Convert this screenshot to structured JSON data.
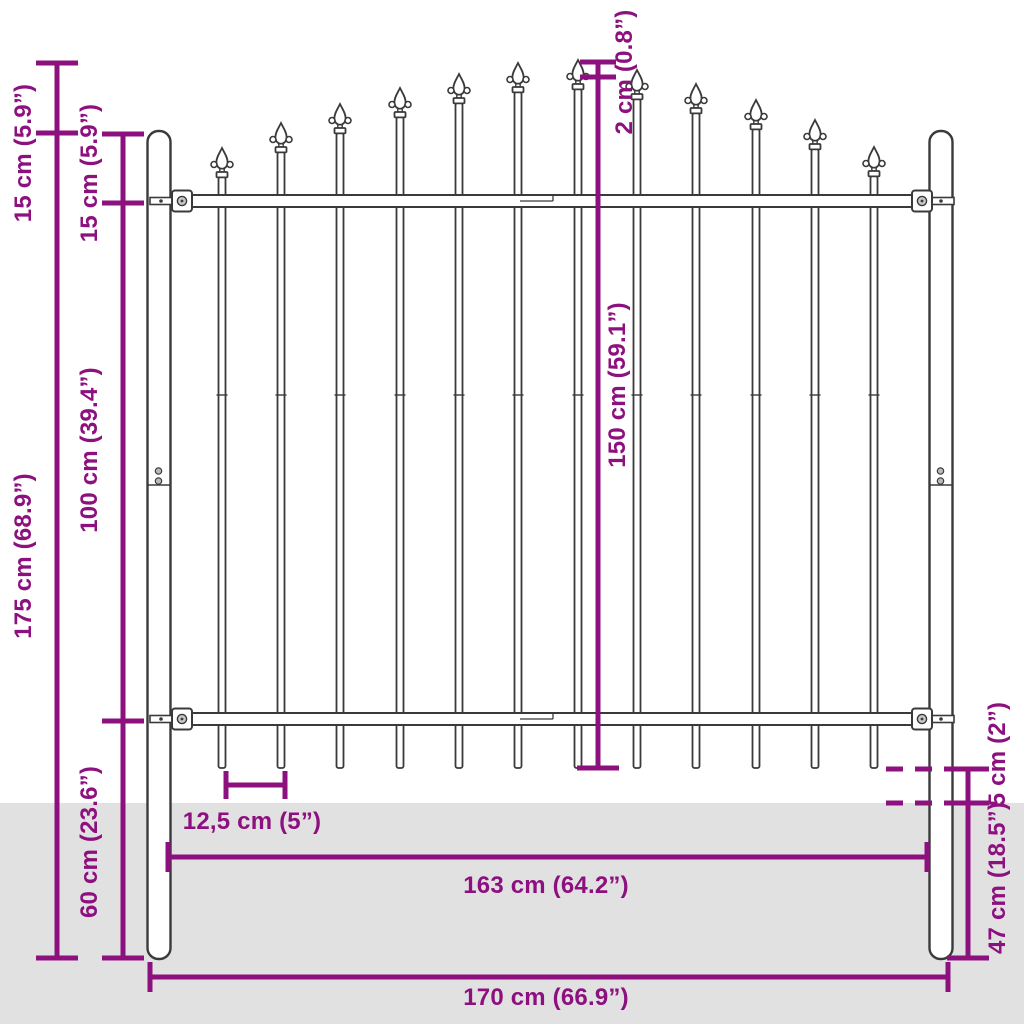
{
  "title": "Fence panel dimension diagram",
  "colors": {
    "dimension_accent": "#8D107F",
    "ground": "#E2E1E2",
    "fence_outline": "#3A3A3A",
    "background": "#FFFFFF"
  },
  "fence": {
    "type": "steel fence panel with spear-top pickets and round posts",
    "picket_count": 12,
    "post_count": 2,
    "rail_count": 2
  },
  "dimensions": {
    "post_above_spears": {
      "label": "15 cm (5.9”)",
      "orientation": "vertical"
    },
    "post_top_to_top_rail": {
      "label": "15 cm (5.9”)",
      "orientation": "vertical"
    },
    "between_rails": {
      "label": "100 cm (39.4”)",
      "orientation": "vertical"
    },
    "post_length": {
      "label": "175 cm (68.9”)",
      "orientation": "vertical"
    },
    "bottom_rail_to_post_end": {
      "label": "60 cm (23.6”)",
      "orientation": "vertical"
    },
    "spear_tip_offset": {
      "label": "2 cm (0.8”)",
      "orientation": "vertical"
    },
    "picket_height": {
      "label": "150 cm (59.1”)",
      "orientation": "vertical"
    },
    "picket_bottom_to_ground": {
      "label": "5 cm (2”)",
      "orientation": "vertical"
    },
    "below_ground_depth": {
      "label": "47 cm (18.5”)",
      "orientation": "vertical"
    },
    "picket_spacing": {
      "label": "12,5 cm (5”)",
      "orientation": "horizontal"
    },
    "inner_width": {
      "label": "163 cm (64.2”)",
      "orientation": "horizontal"
    },
    "total_width": {
      "label": "170 cm (66.9”)",
      "orientation": "horizontal"
    }
  }
}
